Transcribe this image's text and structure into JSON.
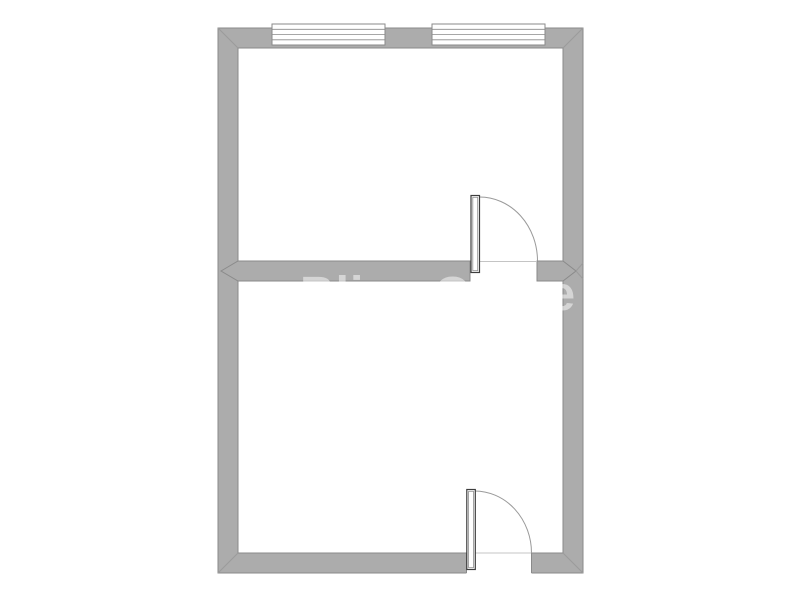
{
  "title": "Two-room floor plan drawing",
  "colors": {
    "background": "#ffffff",
    "wall_fill": "#acacac",
    "wall_outline": "#8a8a8a",
    "door_leaf_outline": "#3d3d3d",
    "swing_arc": "#9a9a9a",
    "watermark_fill": "#ffffff"
  },
  "watermark": {
    "text": "Bliss Office"
  },
  "floorplan": {
    "type": "2-room rectangular floor plan, no dimension labels",
    "rooms": [
      {
        "name": "upper room",
        "features": [
          "two windows on top wall",
          "single-swing door in dividing wall, right side, opening into upper room"
        ]
      },
      {
        "name": "lower room",
        "features": [
          "single-swing door in bottom wall, right side, opening into lower room"
        ]
      }
    ],
    "windows": [
      {
        "name": "window-1",
        "location": "top wall, left",
        "style": "triple-glazing-line symbol"
      },
      {
        "name": "window-2",
        "location": "top wall, right",
        "style": "triple-glazing-line symbol"
      }
    ],
    "doors": [
      {
        "name": "upper-door",
        "location": "dividing wall, right side",
        "swing": "quarter-circle arc into upper room"
      },
      {
        "name": "lower-door",
        "location": "bottom wall, right side",
        "swing": "quarter-circle arc into lower room"
      }
    ]
  }
}
